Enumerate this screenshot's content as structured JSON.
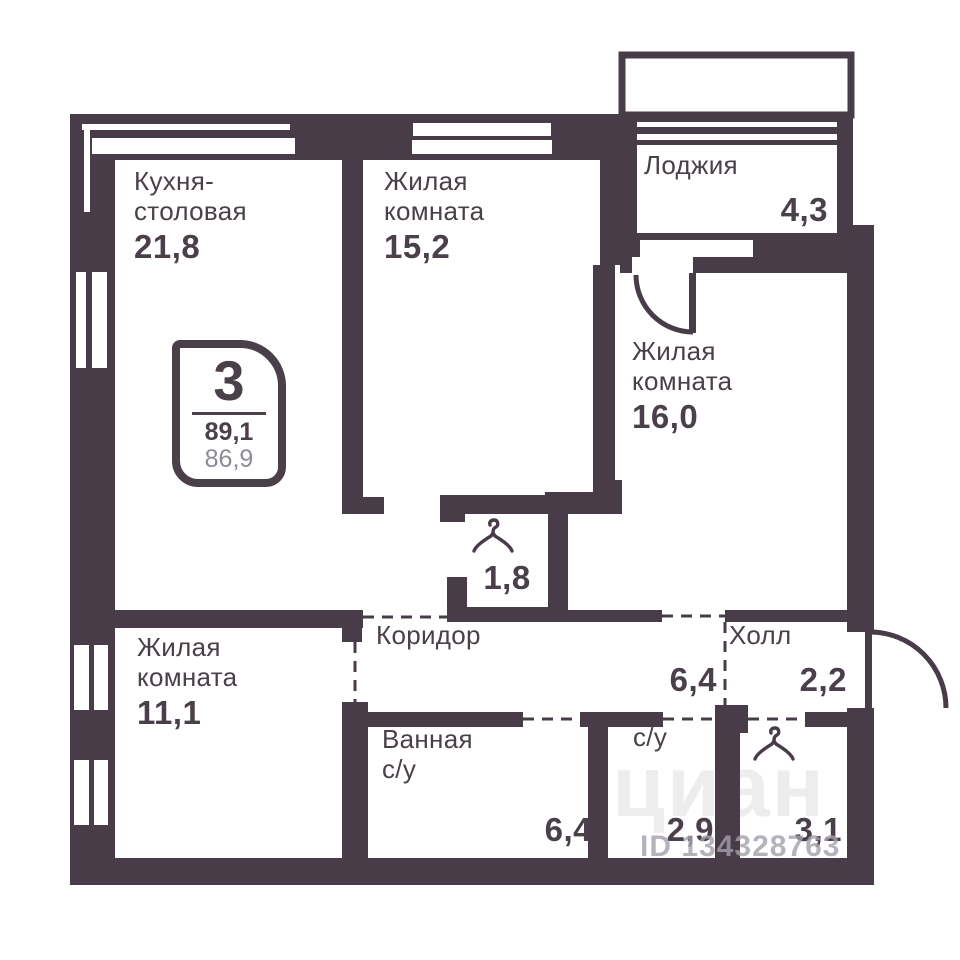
{
  "plan_title": "3-room apartment floor plan",
  "badge": {
    "room_count": "3",
    "total_area": "89,1",
    "living_area": "86,9"
  },
  "rooms": {
    "kitchen": {
      "line1": "Кухня-",
      "line2": "столовая",
      "area": "21,8"
    },
    "living1": {
      "line1": "Жилая",
      "line2": "комната",
      "area": "15,2"
    },
    "loggia": {
      "line1": "Лоджия",
      "area": "4,3"
    },
    "living2": {
      "line1": "Жилая",
      "line2": "комната",
      "area": "16,0"
    },
    "closet": {
      "area": "1,8"
    },
    "corridor": {
      "line1": "Коридор",
      "area": "6,4"
    },
    "hall": {
      "line1": "Холл",
      "area": "2,2"
    },
    "living3": {
      "line1": "Жилая",
      "line2": "комната",
      "area": "11,1"
    },
    "bathroom": {
      "line1": "Ванная",
      "line2": "с/у",
      "area": "6,4"
    },
    "wc": {
      "line1": "с/у",
      "area": "2,9"
    },
    "wardrobe": {
      "area": "3,1"
    }
  },
  "watermark": {
    "logo": "циан",
    "id_text": "ID 134328763"
  },
  "colors": {
    "wall": "#473c47",
    "text": "#4a4049",
    "muted": "#8f8a96",
    "wm": "#a59fab"
  }
}
